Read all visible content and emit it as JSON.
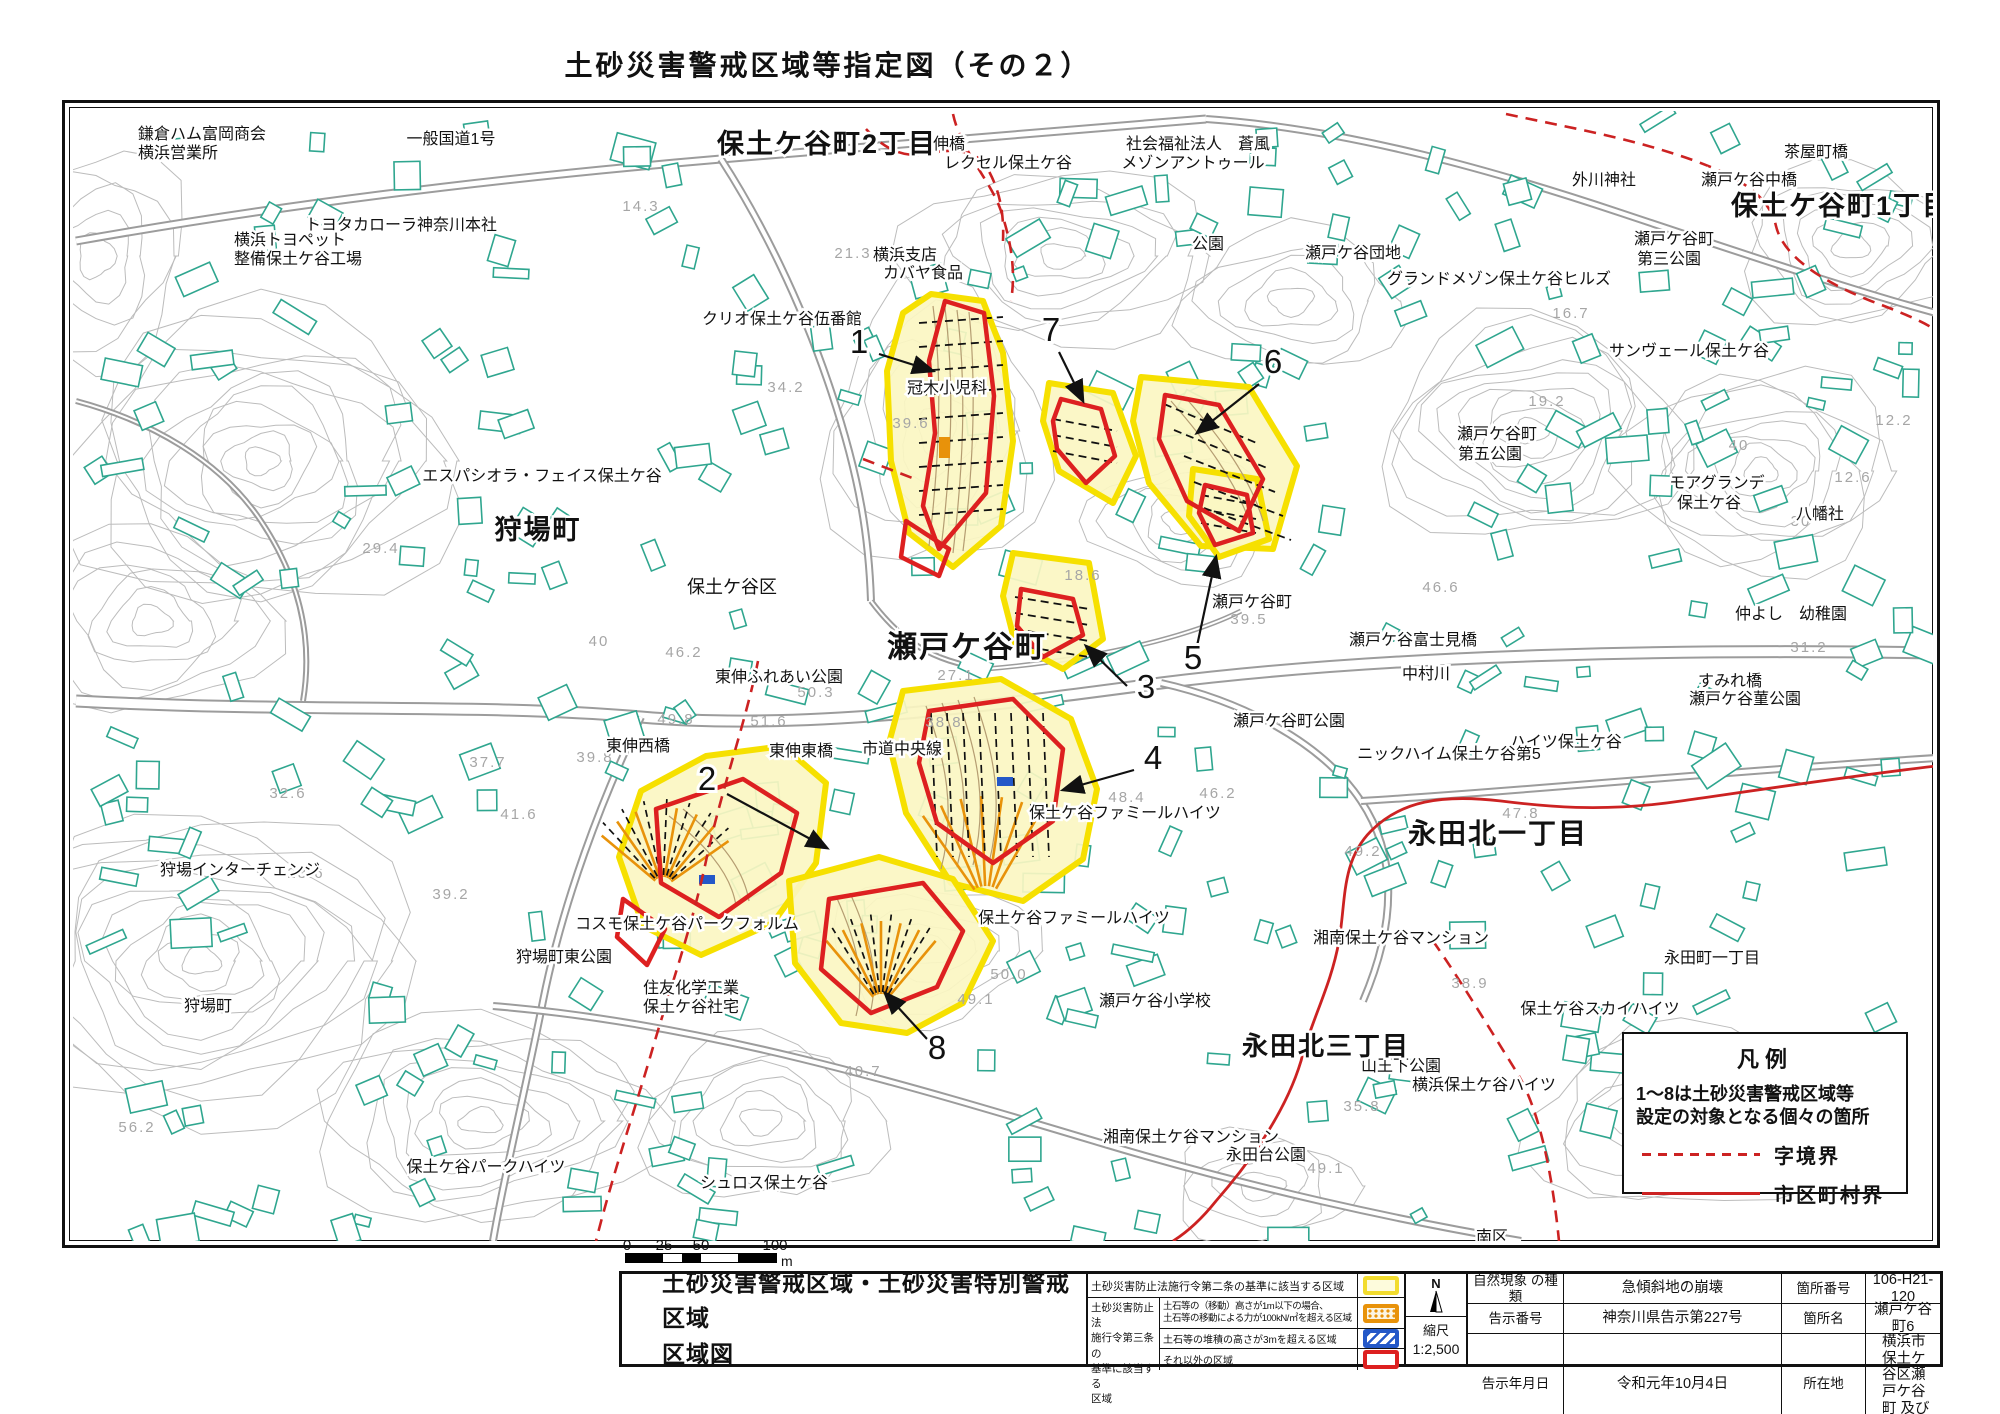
{
  "title": "土砂災害警戒区域等指定図（その２）",
  "colors": {
    "boundary_red": "#cc2222",
    "zone_yellow": "#f6e000",
    "zone_yellow_fill": "#fbf6c2",
    "zone_red": "#dd2020",
    "zone_orange": "#e8920a",
    "zone_blue": "#2458c8",
    "building_teal": "#2fa68f",
    "contour_gray": "#bcbcbc",
    "road_gray": "#9c9c9c"
  },
  "map": {
    "legend_box": {
      "title": "凡例",
      "note_line1": "1～8は土砂災害警戒区域等",
      "note_line2": "設定の対象となる個々の箇所",
      "items": [
        {
          "style": "dashed-red",
          "label": "字境界"
        },
        {
          "style": "solid-red",
          "label": "市区町村界"
        }
      ]
    },
    "district_labels": [
      {
        "t": "保土ケ谷町2丁目",
        "x": 826,
        "y": 152,
        "s": 27
      },
      {
        "t": "保土ケ谷町1丁目",
        "x": 1840,
        "y": 214,
        "s": 27
      },
      {
        "t": "狩場町",
        "x": 537,
        "y": 538,
        "s": 27
      },
      {
        "t": "瀬戸ケ谷町",
        "x": 966,
        "y": 656,
        "s": 30
      },
      {
        "t": "永田北一丁目",
        "x": 1497,
        "y": 842,
        "s": 28
      },
      {
        "t": "永田北三丁目",
        "x": 1325,
        "y": 1054,
        "s": 26
      }
    ],
    "place_labels": [
      {
        "t": "鎌倉ハム富岡商会",
        "x": 137,
        "y": 138,
        "a": "start"
      },
      {
        "t": "横浜営業所",
        "x": 137,
        "y": 157,
        "a": "start"
      },
      {
        "t": "一般国道1号",
        "x": 450,
        "y": 143
      },
      {
        "t": "トヨタカローラ神奈川本社",
        "x": 400,
        "y": 229
      },
      {
        "t": "横浜トヨペット",
        "x": 233,
        "y": 244,
        "a": "start"
      },
      {
        "t": "整備保土ケ谷工場",
        "x": 233,
        "y": 263,
        "a": "start"
      },
      {
        "t": "東伸橋",
        "x": 940,
        "y": 148
      },
      {
        "t": "レクセル保土ケ谷",
        "x": 1007,
        "y": 167
      },
      {
        "t": "横浜支店",
        "x": 872,
        "y": 259,
        "a": "start"
      },
      {
        "t": "カバヤ食品",
        "x": 882,
        "y": 277,
        "a": "start"
      },
      {
        "t": "社会福祉法人　蒼風",
        "x": 1197,
        "y": 148
      },
      {
        "t": "メゾンアントゥール",
        "x": 1192,
        "y": 167
      },
      {
        "t": "公園",
        "x": 1207,
        "y": 248
      },
      {
        "t": "瀬戸ケ谷団地",
        "x": 1352,
        "y": 257
      },
      {
        "t": "外川神社",
        "x": 1603,
        "y": 184
      },
      {
        "t": "瀬戸ケ谷中橋",
        "x": 1748,
        "y": 184
      },
      {
        "t": "茶屋町橋",
        "x": 1815,
        "y": 156
      },
      {
        "t": "瀬戸ケ谷町",
        "x": 1673,
        "y": 243
      },
      {
        "t": "第三公園",
        "x": 1668,
        "y": 263
      },
      {
        "t": "グランドメゾン保土ケ谷ヒルズ",
        "x": 1498,
        "y": 283
      },
      {
        "t": "サンヴェール保土ケ谷",
        "x": 1688,
        "y": 355
      },
      {
        "t": "瀬戸ケ谷町",
        "x": 1496,
        "y": 438
      },
      {
        "t": "第五公園",
        "x": 1489,
        "y": 458
      },
      {
        "t": "モアグランデ",
        "x": 1716,
        "y": 487
      },
      {
        "t": "保土ケ谷",
        "x": 1708,
        "y": 507
      },
      {
        "t": "八幡社",
        "x": 1819,
        "y": 518
      },
      {
        "t": "クリオ保土ケ谷伍番館",
        "x": 781,
        "y": 323
      },
      {
        "t": "冠木小児科",
        "x": 946,
        "y": 392
      },
      {
        "t": "エスパシオラ・フェイス保土ケ谷",
        "x": 541,
        "y": 480
      },
      {
        "t": "保土ケ谷区",
        "x": 731,
        "y": 592,
        "s": 18
      },
      {
        "t": "東伸ふれあい公園",
        "x": 778,
        "y": 681
      },
      {
        "t": "東伸西橋",
        "x": 637,
        "y": 750
      },
      {
        "t": "東伸東橋",
        "x": 800,
        "y": 755
      },
      {
        "t": "市道中央線",
        "x": 901,
        "y": 753
      },
      {
        "t": "瀬戸ケ谷町",
        "x": 1251,
        "y": 606
      },
      {
        "t": "瀬戸ケ谷富士見橋",
        "x": 1412,
        "y": 644
      },
      {
        "t": "中村川",
        "x": 1425,
        "y": 678
      },
      {
        "t": "すみれ橋",
        "x": 1729,
        "y": 685
      },
      {
        "t": "瀬戸ケ谷菫公園",
        "x": 1744,
        "y": 703
      },
      {
        "t": "ハイツ保土ケ谷",
        "x": 1565,
        "y": 746
      },
      {
        "t": "ニックハイム保土ケ谷第5",
        "x": 1448,
        "y": 758
      },
      {
        "t": "瀬戸ケ谷町公園",
        "x": 1288,
        "y": 725
      },
      {
        "t": "仲よし　幼稚園",
        "x": 1790,
        "y": 618
      },
      {
        "t": "保土ケ谷ファミールハイツ",
        "x": 1124,
        "y": 817
      },
      {
        "t": "保土ケ谷ファミールハイツ",
        "x": 1073,
        "y": 922
      },
      {
        "t": "瀬戸ケ谷小学校",
        "x": 1154,
        "y": 1005
      },
      {
        "t": "湘南保土ケ谷マンション",
        "x": 1400,
        "y": 942
      },
      {
        "t": "湘南保土ケ谷マンション",
        "x": 1190,
        "y": 1141
      },
      {
        "t": "永田台公園",
        "x": 1265,
        "y": 1159
      },
      {
        "t": "永田町一丁目",
        "x": 1711,
        "y": 962
      },
      {
        "t": "保土ケ谷スカイハイツ",
        "x": 1599,
        "y": 1013
      },
      {
        "t": "山王下公園",
        "x": 1400,
        "y": 1070
      },
      {
        "t": "横浜保土ケ谷ハイツ",
        "x": 1483,
        "y": 1089
      },
      {
        "t": "狩場インターチェンジ",
        "x": 239,
        "y": 874
      },
      {
        "t": "狩場町東公園",
        "x": 563,
        "y": 961
      },
      {
        "t": "狩場町",
        "x": 207,
        "y": 1010
      },
      {
        "t": "コスモ保土ケ谷パークフォルム",
        "x": 686,
        "y": 928
      },
      {
        "t": "住友化学工業",
        "x": 642,
        "y": 992,
        "a": "start"
      },
      {
        "t": "保土ケ谷社宅",
        "x": 642,
        "y": 1011,
        "a": "start"
      },
      {
        "t": "保土ケ谷パークハイツ",
        "x": 485,
        "y": 1171
      },
      {
        "t": "シュロス保土ケ谷",
        "x": 763,
        "y": 1187
      },
      {
        "t": "南区",
        "x": 1491,
        "y": 1241
      }
    ],
    "elevation_labels": [
      {
        "t": "14.3",
        "x": 640,
        "y": 210
      },
      {
        "t": "21.3",
        "x": 852,
        "y": 257
      },
      {
        "t": "34.2",
        "x": 785,
        "y": 391
      },
      {
        "t": "39.6",
        "x": 910,
        "y": 427
      },
      {
        "t": "16.7",
        "x": 1570,
        "y": 317
      },
      {
        "t": "19.2",
        "x": 1546,
        "y": 405
      },
      {
        "t": "12.2",
        "x": 1893,
        "y": 424
      },
      {
        "t": "12.6",
        "x": 1852,
        "y": 481
      },
      {
        "t": "31.2",
        "x": 1808,
        "y": 651
      },
      {
        "t": "46.6",
        "x": 1440,
        "y": 591
      },
      {
        "t": "18.6",
        "x": 1082,
        "y": 579
      },
      {
        "t": "39.5",
        "x": 1248,
        "y": 623
      },
      {
        "t": "27.1",
        "x": 955,
        "y": 679
      },
      {
        "t": "50.3",
        "x": 815,
        "y": 696
      },
      {
        "t": "51.6",
        "x": 768,
        "y": 725
      },
      {
        "t": "38.8",
        "x": 943,
        "y": 726
      },
      {
        "t": "46.2",
        "x": 683,
        "y": 656
      },
      {
        "t": "40",
        "x": 598,
        "y": 645
      },
      {
        "t": "49.8",
        "x": 675,
        "y": 723
      },
      {
        "t": "39.8",
        "x": 594,
        "y": 761
      },
      {
        "t": "37.7",
        "x": 487,
        "y": 766
      },
      {
        "t": "32.6",
        "x": 287,
        "y": 797
      },
      {
        "t": "41.6",
        "x": 518,
        "y": 818
      },
      {
        "t": "23.6",
        "x": 305,
        "y": 877
      },
      {
        "t": "39.2",
        "x": 450,
        "y": 898
      },
      {
        "t": "29.4",
        "x": 380,
        "y": 552
      },
      {
        "t": "56.2",
        "x": 136,
        "y": 1131
      },
      {
        "t": "48.4",
        "x": 1126,
        "y": 801
      },
      {
        "t": "46.2",
        "x": 1217,
        "y": 797
      },
      {
        "t": "49.2",
        "x": 1362,
        "y": 855
      },
      {
        "t": "47.8",
        "x": 1520,
        "y": 817
      },
      {
        "t": "38.9",
        "x": 1469,
        "y": 987
      },
      {
        "t": "35.8",
        "x": 1361,
        "y": 1110
      },
      {
        "t": "48.6",
        "x": 1265,
        "y": 1047
      },
      {
        "t": "49.1",
        "x": 975,
        "y": 1003
      },
      {
        "t": "49.1",
        "x": 1325,
        "y": 1172
      },
      {
        "t": "50.0",
        "x": 1008,
        "y": 978
      },
      {
        "t": "40.7",
        "x": 862,
        "y": 1075
      },
      {
        "t": "30",
        "x": 1800,
        "y": 525
      },
      {
        "t": "40",
        "x": 1738,
        "y": 449
      }
    ],
    "markers": [
      {
        "n": "1",
        "x": 858,
        "y": 352,
        "x1": 878,
        "y1": 353,
        "x2": 932,
        "y2": 370
      },
      {
        "n": "7",
        "x": 1050,
        "y": 340,
        "x1": 1058,
        "y1": 351,
        "x2": 1082,
        "y2": 400
      },
      {
        "n": "6",
        "x": 1272,
        "y": 372,
        "x1": 1258,
        "y1": 383,
        "x2": 1196,
        "y2": 432
      },
      {
        "n": "5",
        "x": 1192,
        "y": 668,
        "x1": 1196,
        "y1": 645,
        "x2": 1215,
        "y2": 556
      },
      {
        "n": "3",
        "x": 1145,
        "y": 697,
        "x1": 1126,
        "y1": 685,
        "x2": 1085,
        "y2": 645
      },
      {
        "n": "4",
        "x": 1152,
        "y": 768,
        "x1": 1133,
        "y1": 769,
        "x2": 1062,
        "y2": 789
      },
      {
        "n": "2",
        "x": 706,
        "y": 789,
        "x1": 726,
        "y1": 793,
        "x2": 826,
        "y2": 847
      },
      {
        "n": "8",
        "x": 936,
        "y": 1058,
        "x1": 926,
        "y1": 1038,
        "x2": 884,
        "y2": 992
      }
    ]
  },
  "scale_bar": {
    "ticks": [
      "0",
      "25",
      "50",
      "100"
    ],
    "unit": "m"
  },
  "footer": {
    "sheet_title_line1": "土砂災害警戒区域・土砂災害特別警戒区域",
    "sheet_title_line2": "区域図",
    "zone_table": {
      "row_article2": {
        "label": "土砂災害防止法施行令第二条の基準に該当する区域",
        "swatch": "yellow"
      },
      "article3_label_lines": [
        "土砂災害防止法",
        "施行令第三条の",
        "基準に該当する",
        "区域"
      ],
      "rows": [
        {
          "line1": "土石等の（移動）高さが1m以下の場合、",
          "line2": "土石等の移動による力が100kN/㎡を超える区域",
          "swatch": "orange"
        },
        {
          "line1": "土石等の堆積の高さが3mを超える区域",
          "line2": "",
          "swatch": "blue"
        },
        {
          "line1": "それ以外の区域",
          "line2": "",
          "swatch": "red"
        }
      ]
    },
    "compass_label": "N",
    "scale_label": "縮尺",
    "scale_value": "1:2,500",
    "info_table": {
      "rows": [
        {
          "k1": "自然現象 の種類",
          "v1": "急傾斜地の崩壊",
          "k2": "箇所番号",
          "v2": "106-H21-120"
        },
        {
          "k1": "告示番号",
          "v1": "神奈川県告示第227号",
          "k2": "箇所名",
          "v2": "瀬戸ケ谷町6"
        },
        {
          "k1": "告示年月日",
          "v1": "令和元年10月4日",
          "k2": "所在地",
          "v2": "横浜市保土ケ谷区瀬戸ケ谷町 及び狩場町"
        }
      ]
    }
  }
}
